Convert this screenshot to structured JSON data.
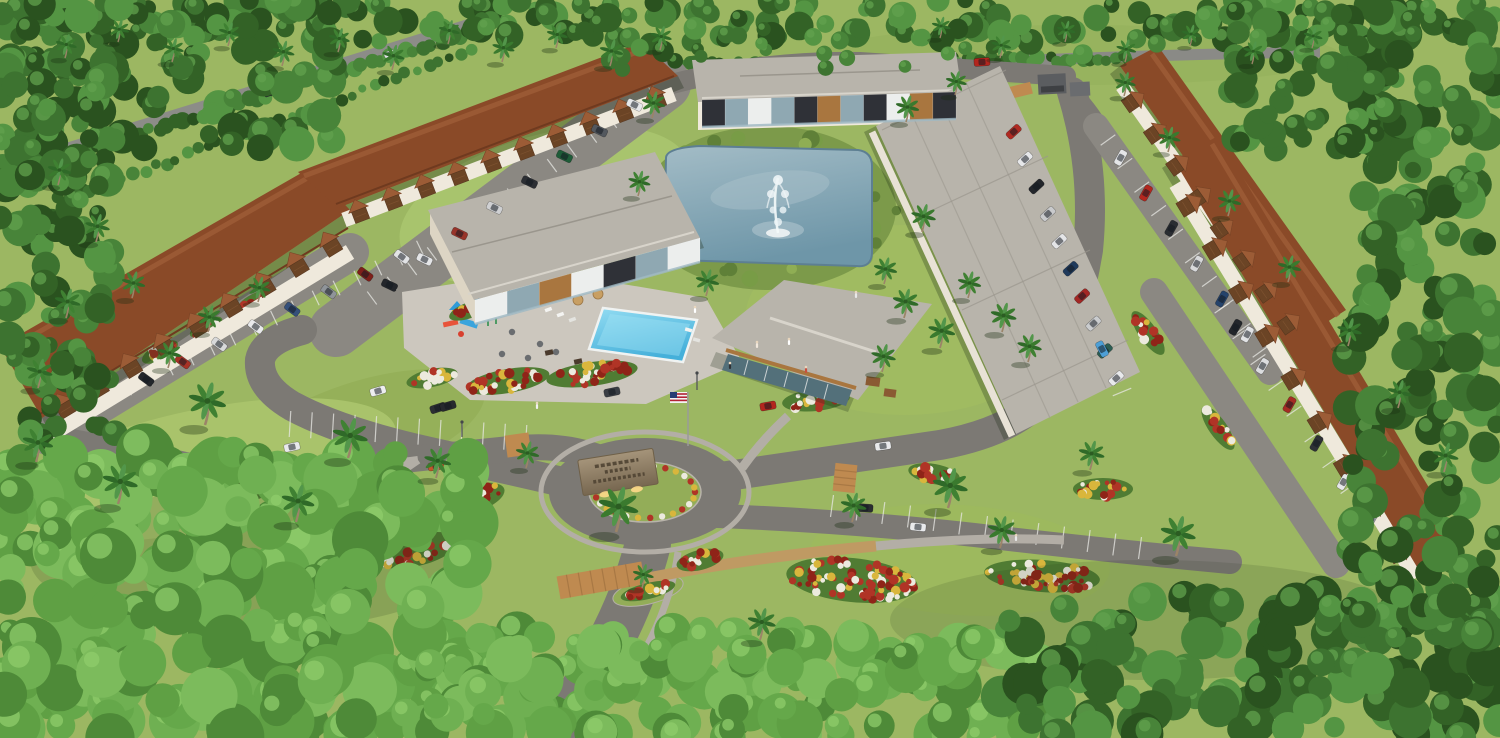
{
  "meta": {
    "type": "3d-aerial-architectural-rendering",
    "description": "Aerial rendering of a tropical condominium community: central retention pond with fountain, swimming pool and playground, clubhouse, modern apartment buildings, rows of garage townhomes with brown tile roofs, entrance roundabout with engraved stone monument sign, landscaped flower beds, surface parking with cars, American flag, dense palm-tree forest border"
  },
  "labels": {
    "pond": "retention pond",
    "fountain": "pond fountain",
    "pool": "swimming pool",
    "pool_deck": "pool deck and lounge area",
    "playground": "playground",
    "clubhouse": "clubhouse",
    "apartment_top": "two-story apartment building",
    "apartment_left": "two-story apartment building",
    "building_right": "long shingle-roof residential building",
    "garage_rows": "garage townhome rows with brown tile roofs",
    "roundabout": "entrance roundabout",
    "sign": "engraved stone monument sign (text illegible at this resolution)",
    "flag": "american flag on flagpole",
    "entrance_road": "entrance drive",
    "median": "landscaped median island",
    "parking": "surface parking with striped stalls",
    "forest": "dense tropical tree line with palms",
    "crosswalk": "brick paver crosswalk",
    "trash_enclosure": "dumpster enclosure"
  },
  "counts": {
    "palm_trees": 61,
    "parked_cars": 55,
    "flower_beds": 20,
    "people": 9
  },
  "palette": {
    "lawn": "#9cb762",
    "lawn_light": "#a8c46d",
    "road": "#7c7974",
    "parking": "#8b8882",
    "deck": "#ccc7be",
    "sidewalk": "#b3aea6",
    "pond_light": "#9db7c2",
    "pond_dark": "#6e96a8",
    "pool_light": "#8fd9f0",
    "pool_dark": "#49b4dc",
    "roof_brown": "#8a4a28",
    "roof_brown_hi": "#9c5c36",
    "roof_gray": "#b8b4ab",
    "wall": "#efe9dc",
    "wood": "#a9763f",
    "dark_panel": "#2f3137",
    "glass": "#53707a",
    "crosswalk": "#bf8a50",
    "paver": "#bf9a63",
    "flower_red": "#b03426",
    "flower_yellow": "#d9b63c",
    "flower_white": "#eceade",
    "grass_tall": "#7c9a4a",
    "stone": "#94836a"
  },
  "scene": {
    "forests": [
      {
        "x": 0,
        "y": 0,
        "w": 1500,
        "h": 42,
        "n": 210,
        "r0": 7,
        "r1": 15,
        "seed": 11,
        "bright": false
      },
      {
        "x": 600,
        "y": 34,
        "w": 740,
        "h": 38,
        "n": 26,
        "r0": 6,
        "r1": 11,
        "seed": 12,
        "bright": false
      },
      {
        "x": 0,
        "y": 0,
        "w": 340,
        "h": 150,
        "n": 85,
        "r0": 8,
        "r1": 18,
        "seed": 13,
        "bright": false
      },
      {
        "x": 0,
        "y": 60,
        "w": 115,
        "h": 380,
        "n": 120,
        "r0": 8,
        "r1": 18,
        "seed": 14,
        "bright": false
      },
      {
        "x": 0,
        "y": 452,
        "w": 470,
        "h": 286,
        "n": 250,
        "r0": 12,
        "r1": 30,
        "seed": 15,
        "bright": true
      },
      {
        "x": 420,
        "y": 630,
        "w": 620,
        "h": 108,
        "n": 150,
        "r0": 10,
        "r1": 24,
        "seed": 16,
        "bright": true
      },
      {
        "x": 1000,
        "y": 592,
        "w": 500,
        "h": 146,
        "n": 150,
        "r0": 10,
        "r1": 22,
        "seed": 17,
        "bright": false
      },
      {
        "x": 1348,
        "y": 14,
        "w": 152,
        "h": 626,
        "n": 190,
        "r0": 8,
        "r1": 20,
        "seed": 18,
        "bright": false
      },
      {
        "x": 1225,
        "y": 10,
        "w": 175,
        "h": 140,
        "n": 60,
        "r0": 8,
        "r1": 16,
        "seed": 19,
        "bright": false
      }
    ],
    "hedges": [
      {
        "x1": 0,
        "y1": 178,
        "x2": 476,
        "y2": 30,
        "n": 55,
        "r0": 5,
        "r1": 9,
        "seed": 21
      },
      {
        "x1": 648,
        "y1": 66,
        "x2": 1130,
        "y2": 58,
        "n": 60,
        "r0": 5,
        "r1": 8,
        "seed": 22
      },
      {
        "x1": 60,
        "y1": 200,
        "x2": 470,
        "y2": 52,
        "n": 40,
        "r0": 4,
        "r1": 7,
        "seed": 23
      }
    ],
    "stallFans": [
      {
        "x1": 128,
        "y1": 388,
        "x2": 420,
        "y2": 248,
        "n": 14,
        "len": 16
      },
      {
        "x1": 372,
        "y1": 298,
        "x2": 652,
        "y2": 92,
        "n": 14,
        "len": 16
      },
      {
        "x1": 290,
        "y1": 424,
        "x2": 526,
        "y2": 438,
        "n": 11,
        "len": 26
      },
      {
        "x1": 832,
        "y1": 506,
        "x2": 1140,
        "y2": 548,
        "n": 12,
        "len": 22
      },
      {
        "x1": 1008,
        "y1": 118,
        "x2": 1122,
        "y2": 392,
        "n": 12,
        "len": 20
      },
      {
        "x1": 1108,
        "y1": 140,
        "x2": 1260,
        "y2": 352,
        "n": 9,
        "len": 18
      },
      {
        "x1": 1222,
        "y1": 308,
        "x2": 1384,
        "y2": 540,
        "n": 9,
        "len": 18
      }
    ],
    "aisles": [
      {
        "x1": 128,
        "y1": 388,
        "x2": 420,
        "y2": 248,
        "rot": 62,
        "scale": 1,
        "colors": [
          "#23262b",
          "#a83226",
          "#d8d9da",
          "#e9eaec",
          "#35507a",
          "#8f9499",
          "#7e1f1a",
          "#e2e3e5"
        ]
      },
      {
        "x1": 372,
        "y1": 298,
        "x2": 652,
        "y2": 92,
        "rot": 62,
        "scale": 1,
        "colors": [
          "#23262b",
          "#e4e5e7",
          "#98342a",
          "#cfd0d2",
          "#2c2f34",
          "#1e5c38",
          "#53585e",
          "#e7e8ea"
        ]
      },
      {
        "x1": 1008,
        "y1": 118,
        "x2": 1122,
        "y2": 392,
        "rot": 70,
        "scale": 1,
        "colors": [
          "#b02a22",
          "#e6e7e9",
          "#23262b",
          "#c9cacc",
          "#e4e5e7",
          "#1f3a5c",
          "#a32724",
          "#caccce",
          "#2c5d52",
          "#e8e9eb"
        ]
      },
      {
        "x1": 1108,
        "y1": 140,
        "x2": 1260,
        "y2": 352,
        "rot": 65,
        "scale": 1,
        "colors": [
          "#e5e6e8",
          "#b3271f",
          "#2a2d32",
          "#d7d8da",
          "#25436b",
          "#e2e3e5"
        ]
      },
      {
        "x1": 1222,
        "y1": 308,
        "x2": 1384,
        "y2": 540,
        "rot": 65,
        "scale": 1,
        "colors": [
          "#23262b",
          "#dcdddf",
          "#a52c24",
          "#2e3136",
          "#e6e7e9",
          "#9ba0a5"
        ]
      },
      {
        "x1": 180,
        "y1": 122,
        "x2": 420,
        "y2": 44,
        "rot": 0,
        "scale": 0.75,
        "colors": [
          "#e8e9eb",
          "#2c2f34",
          "#d5d6d8",
          "#e3e4e6"
        ]
      }
    ],
    "singleCars": [
      [
        438,
        408,
        -18,
        "#2b2e33"
      ],
      [
        612,
        392,
        -12,
        "#3a3e44"
      ],
      [
        768,
        406,
        -10,
        "#b3261e"
      ],
      [
        883,
        446,
        -8,
        "#e9eaec"
      ],
      [
        918,
        527,
        6,
        "#e9eaec"
      ],
      [
        865,
        508,
        4,
        "#2a2d31"
      ],
      [
        576,
        653,
        28,
        "#1f2226"
      ],
      [
        1102,
        349,
        62,
        "#4d9fd6"
      ],
      [
        292,
        447,
        -12,
        "#e9eaec"
      ],
      [
        378,
        391,
        -16,
        "#edeeef"
      ],
      [
        448,
        406,
        -16,
        "#26292e"
      ],
      [
        436,
        466,
        -10,
        "#c2552a"
      ],
      [
        982,
        62,
        -4,
        "#b3261e"
      ]
    ],
    "beds": [
      {
        "x": 250,
        "y": 481,
        "rx": 52,
        "ry": 20,
        "rot": -22
      },
      {
        "x": 336,
        "y": 528,
        "rx": 62,
        "ry": 24,
        "rot": -16
      },
      {
        "x": 411,
        "y": 549,
        "rx": 46,
        "ry": 18,
        "rot": -10
      },
      {
        "x": 470,
        "y": 500,
        "rx": 36,
        "ry": 14,
        "rot": -18
      },
      {
        "x": 508,
        "y": 381,
        "rx": 42,
        "ry": 12,
        "rot": -10
      },
      {
        "x": 592,
        "y": 374,
        "rx": 46,
        "ry": 12,
        "rot": -8
      },
      {
        "x": 816,
        "y": 400,
        "rx": 34,
        "ry": 11,
        "rot": -6
      },
      {
        "x": 852,
        "y": 580,
        "rx": 66,
        "ry": 22,
        "rot": 6
      },
      {
        "x": 1042,
        "y": 576,
        "rx": 58,
        "ry": 16,
        "rot": 4
      },
      {
        "x": 1103,
        "y": 489,
        "rx": 30,
        "ry": 11,
        "rot": 0
      },
      {
        "x": 934,
        "y": 474,
        "rx": 26,
        "ry": 10,
        "rot": 10
      },
      {
        "x": 1148,
        "y": 333,
        "rx": 26,
        "ry": 9,
        "rot": 55
      },
      {
        "x": 1218,
        "y": 428,
        "rx": 26,
        "ry": 9,
        "rot": 55
      },
      {
        "x": 160,
        "y": 352,
        "rx": 20,
        "ry": 8,
        "rot": -28
      },
      {
        "x": 206,
        "y": 327,
        "rx": 18,
        "ry": 7,
        "rot": -28
      },
      {
        "x": 254,
        "y": 301,
        "rx": 18,
        "ry": 7,
        "rot": -28
      },
      {
        "x": 470,
        "y": 310,
        "rx": 22,
        "ry": 8,
        "rot": -20
      },
      {
        "x": 432,
        "y": 378,
        "rx": 26,
        "ry": 9,
        "rot": -12
      },
      {
        "x": 700,
        "y": 560,
        "rx": 24,
        "ry": 10,
        "rot": -14
      },
      {
        "x": 648,
        "y": 591,
        "rx": 28,
        "ry": 8,
        "rot": -14
      }
    ],
    "palms": [
      [
        65,
        58,
        0.9
      ],
      [
        118,
        42,
        0.85
      ],
      [
        172,
        62,
        0.9
      ],
      [
        228,
        46,
        0.9
      ],
      [
        282,
        66,
        0.95
      ],
      [
        338,
        52,
        0.9
      ],
      [
        392,
        70,
        0.95
      ],
      [
        448,
        44,
        0.9
      ],
      [
        502,
        62,
        0.95
      ],
      [
        556,
        48,
        0.9
      ],
      [
        610,
        66,
        1
      ],
      [
        660,
        50,
        0.9
      ],
      [
        940,
        38,
        0.8
      ],
      [
        1000,
        58,
        0.85
      ],
      [
        1065,
        42,
        0.8
      ],
      [
        1125,
        62,
        0.85
      ],
      [
        1190,
        46,
        0.8
      ],
      [
        1252,
        64,
        0.85
      ],
      [
        1312,
        48,
        0.8
      ],
      [
        58,
        185,
        1
      ],
      [
        96,
        242,
        1.05
      ],
      [
        66,
        318,
        1.1
      ],
      [
        132,
        298,
        1
      ],
      [
        38,
        388,
        1.1
      ],
      [
        208,
        332,
        1
      ],
      [
        258,
        302,
        0.95
      ],
      [
        168,
        368,
        1
      ],
      [
        205,
        425,
        1.6
      ],
      [
        348,
        458,
        1.5
      ],
      [
        118,
        504,
        1.5
      ],
      [
        36,
        462,
        1.3
      ],
      [
        296,
        522,
        1.4
      ],
      [
        436,
        478,
        1.15
      ],
      [
        616,
        532,
        1.7
      ],
      [
        526,
        468,
        1
      ],
      [
        652,
        118,
        1
      ],
      [
        906,
        122,
        1
      ],
      [
        922,
        232,
        1.05
      ],
      [
        638,
        196,
        0.95
      ],
      [
        884,
        284,
        1
      ],
      [
        955,
        95,
        0.9
      ],
      [
        706,
        296,
        1
      ],
      [
        904,
        318,
        1.1
      ],
      [
        940,
        348,
        1.15
      ],
      [
        968,
        298,
        1
      ],
      [
        882,
        372,
        1.05
      ],
      [
        1002,
        332,
        1.1
      ],
      [
        1028,
        362,
        1.05
      ],
      [
        948,
        508,
        1.5
      ],
      [
        1000,
        548,
        1.2
      ],
      [
        1176,
        556,
        1.5
      ],
      [
        1090,
        470,
        1.1
      ],
      [
        852,
        522,
        1.1
      ],
      [
        1124,
        96,
        0.9
      ],
      [
        1168,
        152,
        0.95
      ],
      [
        1228,
        216,
        1
      ],
      [
        1288,
        282,
        1
      ],
      [
        1348,
        346,
        1.05
      ],
      [
        1398,
        408,
        1.05
      ],
      [
        1444,
        472,
        1.1
      ],
      [
        642,
        588,
        0.9
      ],
      [
        760,
        640,
        1.2
      ]
    ],
    "people": [
      [
        537,
        408,
        "#f2f2f2"
      ],
      [
        695,
        312,
        "#ffffff"
      ],
      [
        757,
        347,
        "#f2e8dc"
      ],
      [
        789,
        344,
        "#ffffff"
      ],
      [
        856,
        297,
        "#e8e8e8"
      ],
      [
        806,
        372,
        "#c94f3d"
      ],
      [
        375,
        497,
        "#f2f2f2"
      ],
      [
        1016,
        540,
        "#e8e8e8"
      ],
      [
        730,
        368,
        "#2e3236"
      ]
    ],
    "facades": [
      {
        "x1": 702,
        "y1": 100,
        "x2": 956,
        "y2": 92,
        "h": 27,
        "segs": [
          "dark",
          "win",
          "white",
          "win",
          "dark",
          "wood",
          "win",
          "dark",
          "white",
          "wood",
          "dark"
        ]
      },
      {
        "x1": 475,
        "y1": 300,
        "x2": 700,
        "y2": 238,
        "h": 24,
        "segs": [
          "white",
          "win",
          "wood",
          "white",
          "dark",
          "win",
          "white"
        ]
      }
    ],
    "garageFronts": [
      {
        "x1": 46,
        "y1": 414,
        "x2": 346,
        "y2": 232,
        "n": 9,
        "w": 16,
        "h": 13
      },
      {
        "x1": 342,
        "y1": 216,
        "x2": 672,
        "y2": 90,
        "n": 10,
        "w": 15,
        "h": 12
      },
      {
        "x1": 1124,
        "y1": 84,
        "x2": 1302,
        "y2": 338,
        "n": 8,
        "w": 15,
        "h": 12
      },
      {
        "x1": 1178,
        "y1": 182,
        "x2": 1414,
        "y2": 572,
        "n": 9,
        "w": 16,
        "h": 13
      }
    ],
    "pondGrassSeed": 77,
    "ringFlowerStep": 14
  }
}
